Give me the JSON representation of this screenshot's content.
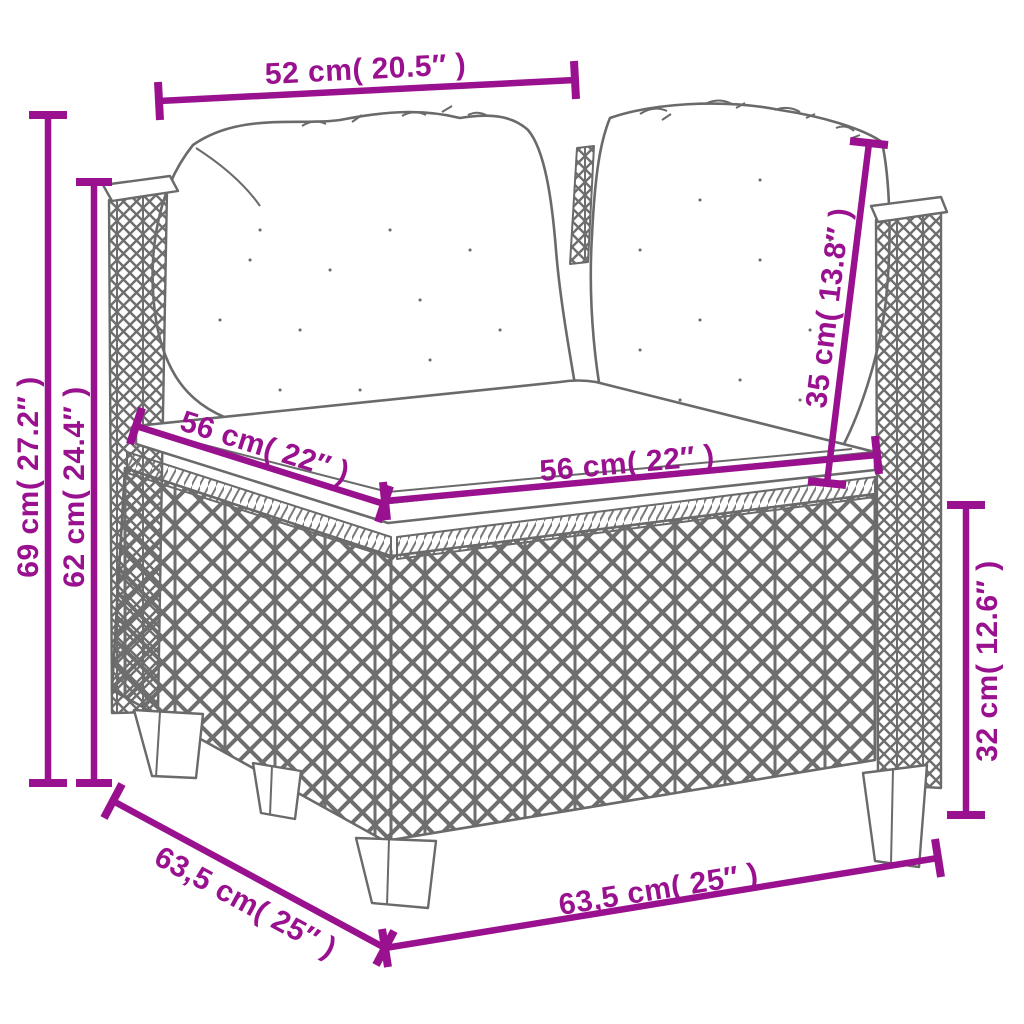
{
  "figure": {
    "description": "Line drawing of a poly rattan corner sofa section with two back cushions and a seat cushion, annotated with product dimensions",
    "colors": {
      "dimension_accent": "#99118F",
      "line_art": "#6a6a6a",
      "background": "#ffffff"
    },
    "dims": {
      "top_width": "52 cm( 20.5″ )",
      "overall_height": "69 cm( 27.2″ )",
      "arm_height": "62 cm( 24.4″ )",
      "seat_depth": "56 cm( 22″ )",
      "seat_width": "56 cm( 22″ )",
      "back_cushion_height": "35 cm( 13.8″ )",
      "base_height": "32 cm( 12.6″ )",
      "footprint_depth": "63,5 cm( 25″ )",
      "footprint_width": "63,5 cm( 25″ )"
    }
  }
}
